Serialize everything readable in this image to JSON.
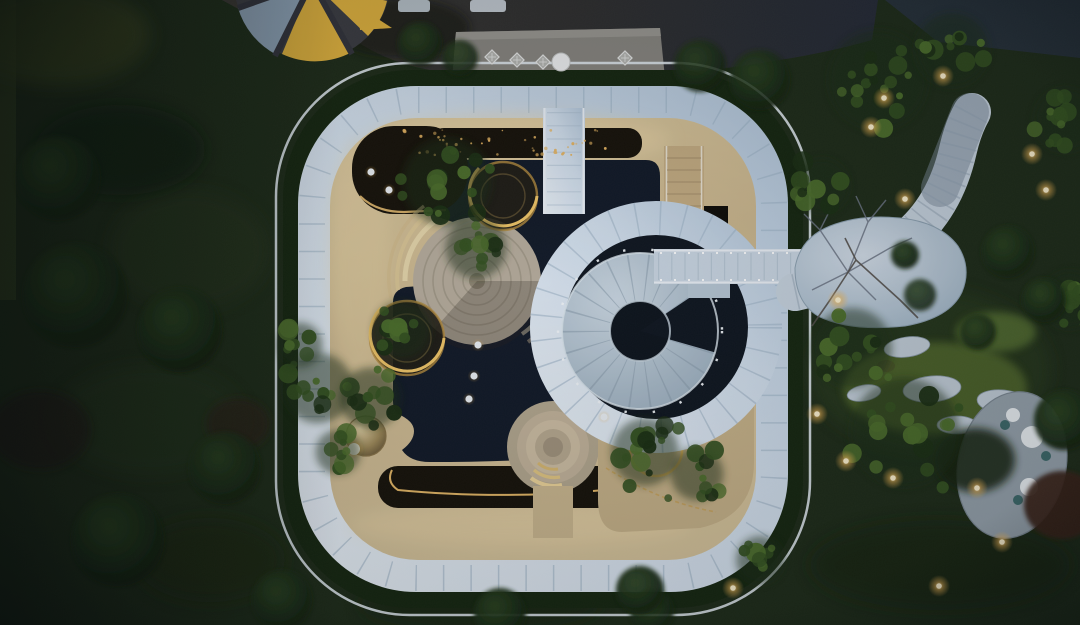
{
  "meta": {
    "title": "Aerial dusk photograph",
    "description": "Top-down drone view of a rounded-square landscape pavilion with reflecting pool, spiral staircase, lit tree planters and surrounding night gardens"
  },
  "palette": {
    "lawn": "#1f2c17",
    "lawn_light": "#2e3d1f",
    "hedge": "#16260f",
    "shrub_dark": "#101d0b",
    "paving": "#34312c",
    "paving_blue": "#2a2f3a",
    "platform": "#8f8c85",
    "umbrella_yellow": "#e2b33c",
    "umbrella_frame": "#3c3c40",
    "umbrella_glass": "#8fa3b5",
    "curb": "#e4ecf2",
    "band_light": "#eaf1f8",
    "band_shade": "#b9cbdc",
    "tan": "#d2be95",
    "tan_bright": "#ecd7a8",
    "pool": "#121926",
    "channel": "#171208",
    "stairs": "#b6c5d1",
    "bridge": "#ccd8e3",
    "plaza_light": "#d6e0ea",
    "plaza_shade": "#a9bccb",
    "stone": "#c4cfd9",
    "grass_bright": "#52692a",
    "oval_plaza": "#98a4ad",
    "canopy": "#35521f",
    "canopy_light": "#4d6e2a",
    "canopy_dark": "#1c2f12",
    "branch": "#5a544c",
    "red_tree": "#3a2016",
    "light_warm": "#ffd27a",
    "light_core": "#fff3cf",
    "gold_edge": "#e8b560",
    "dot_white": "#eef2f6"
  },
  "scene": {
    "garden_lights": [
      [
        943,
        76
      ],
      [
        884,
        98
      ],
      [
        871,
        127
      ],
      [
        905,
        199
      ],
      [
        1032,
        154
      ],
      [
        1046,
        190
      ],
      [
        838,
        300
      ],
      [
        817,
        414
      ],
      [
        846,
        461
      ],
      [
        893,
        478
      ],
      [
        977,
        488
      ],
      [
        1002,
        542
      ],
      [
        939,
        586
      ],
      [
        733,
        588
      ]
    ],
    "pool_lights": [
      [
        371,
        172
      ],
      [
        389,
        190
      ],
      [
        478,
        345
      ],
      [
        474,
        376
      ],
      [
        469,
        399
      ],
      [
        604,
        417
      ]
    ],
    "sparkles": {
      "x": 402,
      "y": 130,
      "w": 236,
      "h": 25,
      "count": 46
    },
    "waterfall_sparkles": {
      "x": 702,
      "y": 210,
      "w": 26,
      "h": 236,
      "count": 30
    },
    "tree_clusters": [
      [
        447,
        182,
        55,
        16
      ],
      [
        476,
        248,
        38,
        10
      ],
      [
        318,
        388,
        44,
        12
      ],
      [
        300,
        345,
        28,
        8
      ],
      [
        402,
        330,
        36,
        10
      ],
      [
        370,
        398,
        38,
        10
      ],
      [
        338,
        452,
        28,
        8
      ],
      [
        645,
        452,
        42,
        14
      ],
      [
        697,
        474,
        33,
        10
      ],
      [
        822,
        186,
        34,
        10
      ],
      [
        878,
        80,
        62,
        18
      ],
      [
        952,
        50,
        46,
        12
      ],
      [
        905,
        432,
        68,
        18
      ],
      [
        852,
        348,
        50,
        14
      ],
      [
        1066,
        120,
        40,
        12
      ],
      [
        1070,
        300,
        36,
        10
      ],
      [
        760,
        560,
        30,
        8
      ]
    ],
    "shrubs": [
      [
        180,
        330,
        42
      ],
      [
        75,
        295,
        52
      ],
      [
        225,
        468,
        36
      ],
      [
        118,
        540,
        46
      ],
      [
        58,
        178,
        42
      ],
      [
        282,
        600,
        30
      ],
      [
        500,
        614,
        26
      ],
      [
        652,
        612,
        22
      ],
      [
        1008,
        252,
        26
      ],
      [
        1044,
        300,
        22
      ],
      [
        978,
        332,
        18
      ],
      [
        920,
        295,
        16
      ],
      [
        1064,
        420,
        30
      ],
      [
        760,
        80,
        30
      ],
      [
        700,
        66,
        26
      ],
      [
        640,
        590,
        24
      ],
      [
        420,
        44,
        22
      ],
      [
        460,
        58,
        18
      ],
      [
        905,
        255,
        14
      ]
    ],
    "stepping_stones": [
      [
        907,
        347,
        23,
        10,
        -8
      ],
      [
        932,
        389,
        29,
        13,
        -5
      ],
      [
        1003,
        402,
        26,
        12,
        6
      ],
      [
        864,
        393,
        17,
        8,
        -10
      ],
      [
        957,
        425,
        20,
        9,
        0
      ]
    ],
    "furniture": {
      "chairs": [
        [
          492,
          57
        ],
        [
          517,
          60
        ],
        [
          543,
          62
        ],
        [
          625,
          58
        ]
      ],
      "table": [
        561,
        62,
        9
      ],
      "oval_tables": [
        [
          1032,
          437,
          11
        ],
        [
          1013,
          415,
          7
        ],
        [
          1029,
          487,
          9
        ]
      ],
      "teal_seats": [
        [
          1005,
          425
        ],
        [
          1046,
          456
        ],
        [
          1018,
          500
        ]
      ]
    }
  }
}
